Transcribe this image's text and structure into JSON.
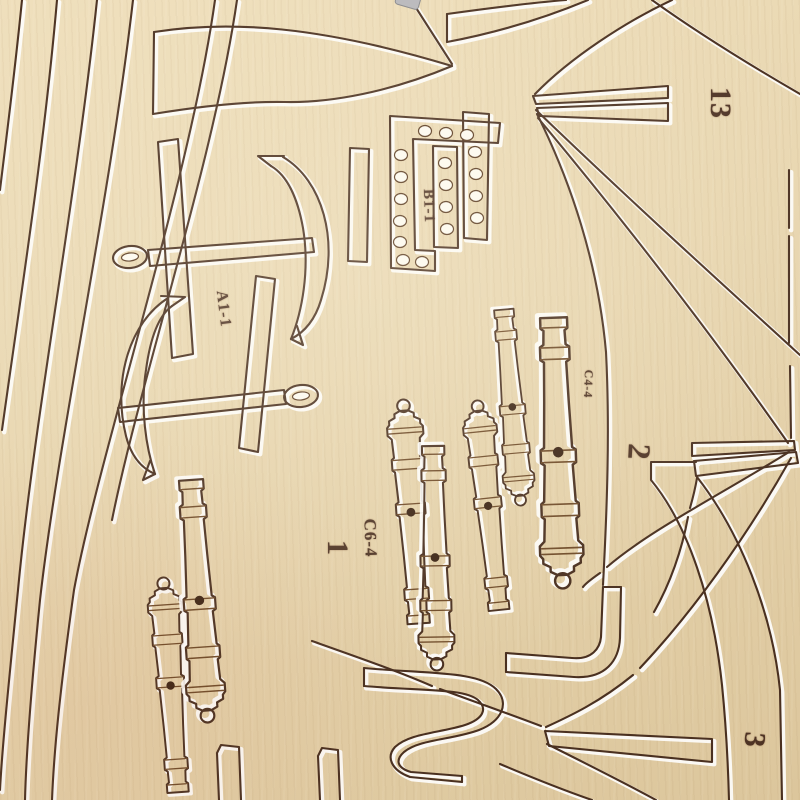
{
  "image": {
    "description": "Close-up photo of a laser-cut wooden ship model kit sheet with cut-out anchors, cannon barrels, a drilled ladder strip and curved frame parts"
  },
  "stamps": {
    "n13": "13",
    "b1": "B1-1",
    "a1": "A1-1",
    "c4": "C4-4",
    "n2": "2",
    "c6": "C6-4",
    "n1": "1",
    "n3": "3"
  },
  "colors": {
    "wood_light": "#efdfbc",
    "wood": "#e7d5ae",
    "wood_dark": "#dcc69c",
    "cut_burn": "#4a3020",
    "cut_ring": "#6e4a28",
    "edge_highlight": "#ffffff",
    "stamp_ink": "#42271a",
    "hole": "#fdfaf1",
    "metal_tab": "#b7b7bb"
  }
}
